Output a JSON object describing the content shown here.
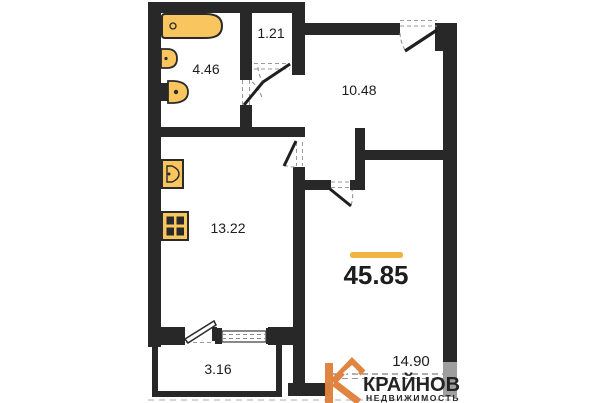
{
  "floor_plan": {
    "total_area": {
      "value": "45.85"
    },
    "rooms": [
      {
        "name": "bathroom",
        "area": "4.46"
      },
      {
        "name": "storage",
        "area": "1.21"
      },
      {
        "name": "hallway",
        "area": "10.48"
      },
      {
        "name": "kitchen",
        "area": "13.22"
      },
      {
        "name": "living-room",
        "area": "14.90"
      },
      {
        "name": "balcony",
        "area": "3.16"
      }
    ],
    "fixtures": [
      "bathtub-icon",
      "washbasin-icon",
      "toilet-icon",
      "kitchen-sink-icon",
      "stove-icon"
    ],
    "colors": {
      "wall": "#282828",
      "cut_wall_grey": "#9E9E9E",
      "fixture_fill": "#F9C55F",
      "accent_line": "#F0B442",
      "logo_orange": "#E0813C"
    }
  },
  "watermark": {
    "brand": "КРАЙНОВ",
    "tagline": "НЕДВИЖИМОСТЬ"
  }
}
